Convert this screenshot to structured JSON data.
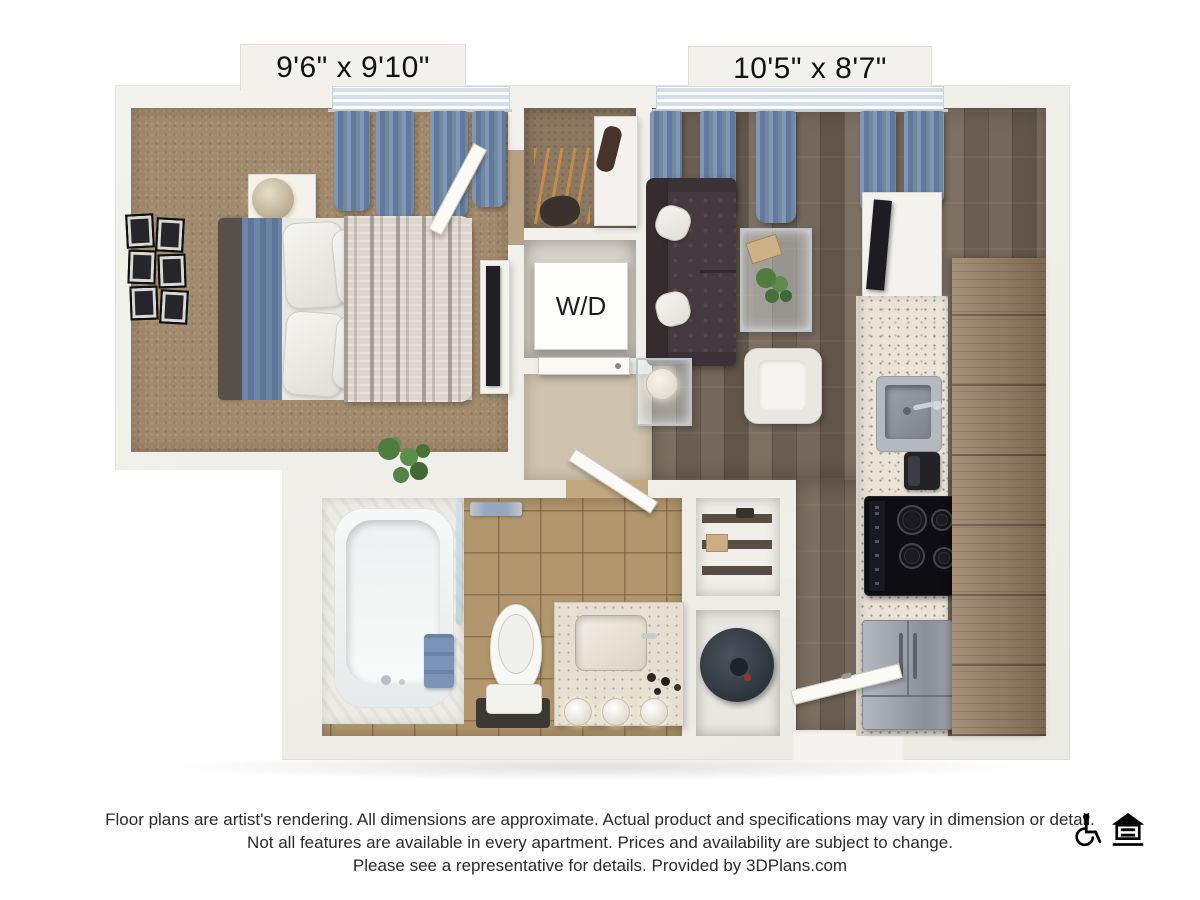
{
  "floorplan": {
    "bedroom": {
      "dimensions": "9'6\" x 9'10\""
    },
    "living_room": {
      "dimensions": "10'5\" x 8'7\""
    },
    "laundry": {
      "label": "W/D"
    },
    "rooms_depicted": [
      "bedroom",
      "closet",
      "laundry-closet",
      "living-room",
      "kitchen",
      "bathroom",
      "pantry-closet",
      "water-heater-closet",
      "entry-hall"
    ],
    "colors": {
      "wall": "#f2f0ec",
      "carpet": "#a28a6d",
      "wood_floor": "#6f6155",
      "bath_tile": "#b2966d",
      "counter_speckle": "#e9e3d8",
      "cabinet_wood": "#937c5f",
      "curtain_blue": "#6d84a6",
      "sofa_brown": "#463a40",
      "appliance_steel": "#9da2a8",
      "text": "#121212"
    }
  },
  "footer": {
    "lines": [
      "Floor plans are artist's rendering. All dimensions are approximate. Actual product and specifications may vary in dimension or detail.",
      "Not all features are available in every apartment. Prices and availability are subject to change.",
      "Please see a representative for details. Provided by 3DPlans.com"
    ],
    "icons": [
      "wheelchair-accessible-icon",
      "equal-housing-opportunity-icon"
    ]
  }
}
